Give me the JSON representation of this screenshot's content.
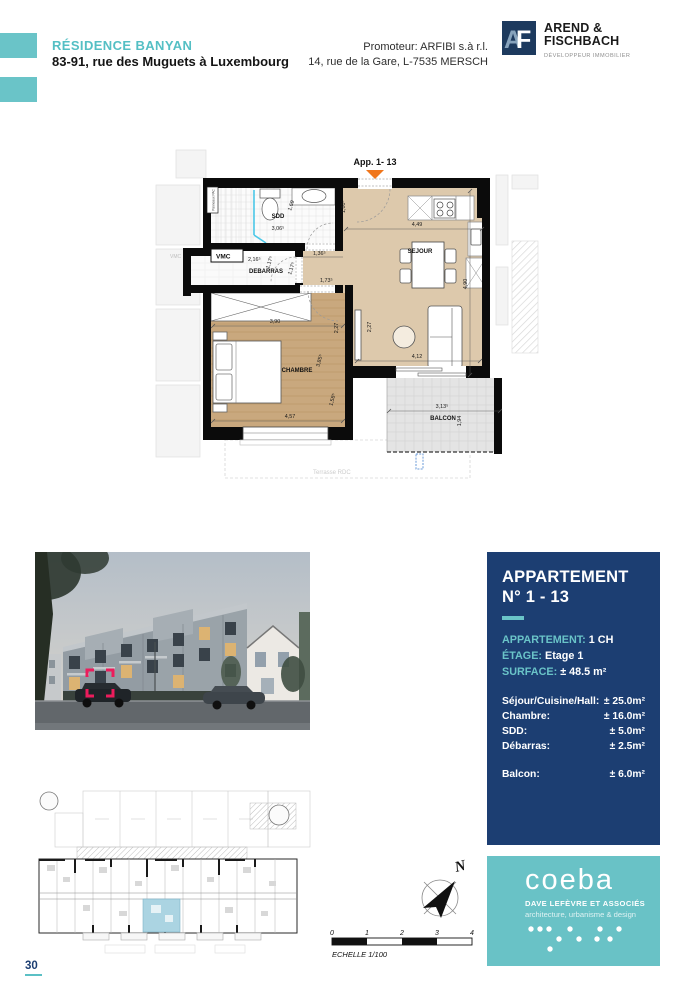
{
  "header": {
    "project_title": "RÉSIDENCE BANYAN",
    "project_address": "83-91, rue des Muguets à Luxembourg",
    "promoter_line1": "Promoteur: ARFIBI s.à r.l.",
    "promoter_line2": "14, rue de la Gare, L-7535 MERSCH",
    "developer": {
      "monogram_a": "A",
      "monogram_f": "F",
      "name_line1": "AREND &",
      "name_line2": "FISCHBACH",
      "tagline": "DÉVELOPPEUR IMMOBILIER"
    }
  },
  "floorplan": {
    "apartment_label": "App. 1- 13",
    "rooms": {
      "sdd": "SDD",
      "vmc": "VMC",
      "debarras": "DEBARRAS",
      "sejour": "SEJOUR",
      "chambre": "CHAMBRE",
      "balcon": "BALCON"
    },
    "dims": {
      "sdd_w": "3,06⁵",
      "sdd_h": "1,69",
      "deb_w": "2,16⁵",
      "deb_h": "1,17⁵",
      "hall_h": "1,17⁵",
      "hall_w1": "1,36⁵",
      "hall_w2": "1,73⁵",
      "entry_h": "1,80⁵",
      "kitchen_w": "4,49",
      "sejour_h": "4,90",
      "ward_w": "3,90",
      "ch_d1": "2,27",
      "ch_d2": "2,27",
      "ch_h": "3,85⁵",
      "ch_win": "1,58⁵",
      "ch_w": "4,57",
      "sej_w": "4,12",
      "balc_w": "3,13⁵",
      "balc_h": "1,94"
    },
    "terrace_label": "Terrasse RDC",
    "pac_label": "Panneaux PAC",
    "neighbor_vmc": "VMC"
  },
  "info_panel": {
    "title_line1": "APPARTEMENT",
    "title_line2": "N° 1 - 13",
    "apartment_label": "APPARTEMENT:",
    "apartment_value": "1 CH",
    "floor_label": "ÉTAGE:",
    "floor_value": "Etage 1",
    "surface_label": "SURFACE:",
    "surface_value": "± 48.5 m²",
    "areas": [
      {
        "label": "Séjour/Cuisine/Hall:",
        "value": "± 25.0m²"
      },
      {
        "label": "Chambre:",
        "value": "± 16.0m²"
      },
      {
        "label": "SDD:",
        "value": "± 5.0m²"
      },
      {
        "label": "Débarras:",
        "value": "± 2.5m²"
      }
    ],
    "balcony_label": "Balcon:",
    "balcony_value": "± 6.0m²"
  },
  "compass": {
    "north_label": "N"
  },
  "scalebar": {
    "ticks": [
      "0",
      "1",
      "2",
      "3",
      "4"
    ],
    "label": "ECHELLE 1/100"
  },
  "architect": {
    "name": "coeba",
    "subtitle": "DAVE LEFÈVRE ET ASSOCIÉS",
    "tagline": "architecture, urbanisme & design"
  },
  "page_number": "30",
  "colors": {
    "teal_accent": "#63c3c7",
    "navy_panel": "#1c3e72",
    "logo_navy": "#1d3a5e",
    "floor_beige": "#ddc9ac",
    "floor_wood": "#c9a87e",
    "entrance_orange": "#f0761c",
    "highlight_pink": "#ec1c5c",
    "siteplan_highlight": "#abd4e2"
  }
}
